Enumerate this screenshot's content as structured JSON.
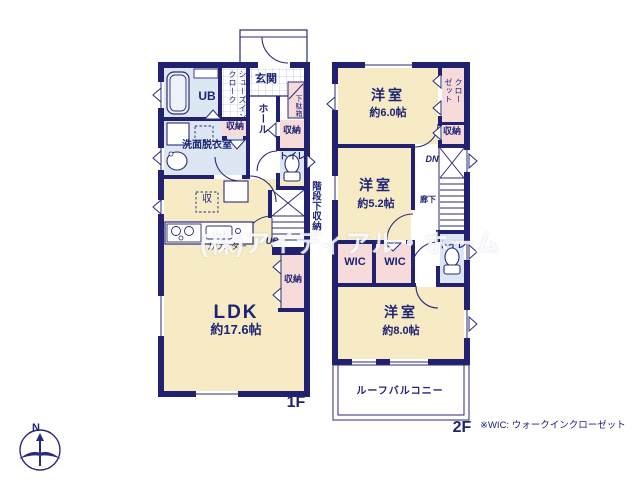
{
  "watermark": "(株)アイディアル・ホーム",
  "compass": {
    "north_label": "N"
  },
  "footnote": "※WIC: ウォークインクローゼット",
  "floor1": {
    "floor_label": "1F",
    "genkan": "玄関",
    "shoes_in_cloak": "シューズインクローク",
    "unit_bath": "UB",
    "shoe_cabinet": "下駄箱",
    "hall": "ホール",
    "storage_entrance": "収納",
    "storage_hall": "収納",
    "washroom": "洗面脱衣室",
    "toilet": "トイレ",
    "under_stairs_storage": "階段下収納",
    "storage_mark": "収",
    "kitchen_counter": "カウンター",
    "stairs_up": "UP",
    "storage_ldk": "収納",
    "ldk_name": "LDK",
    "ldk_size": "約17.6帖"
  },
  "floor2": {
    "floor_label": "2F",
    "bedroom_6_name": "洋室",
    "bedroom_6_size": "約6.0帖",
    "closet": "クローゼット",
    "storage": "収納",
    "stairs_down": "DN",
    "corridor": "廊下",
    "bedroom_5_name": "洋室",
    "bedroom_5_size": "約5.2帖",
    "wic_left": "WIC",
    "wic_right": "WIC",
    "toilet": "トイレ",
    "bedroom_8_name": "洋室",
    "bedroom_8_size": "約8.0帖",
    "roof_balcony": "ルーフバルコニー"
  },
  "colors": {
    "wall": "#212170",
    "room_cream": "#f6ebc5",
    "closet_pink": "#f6dbda",
    "wet_blue": "#dde7f3",
    "text_navy": "#1e2474"
  }
}
